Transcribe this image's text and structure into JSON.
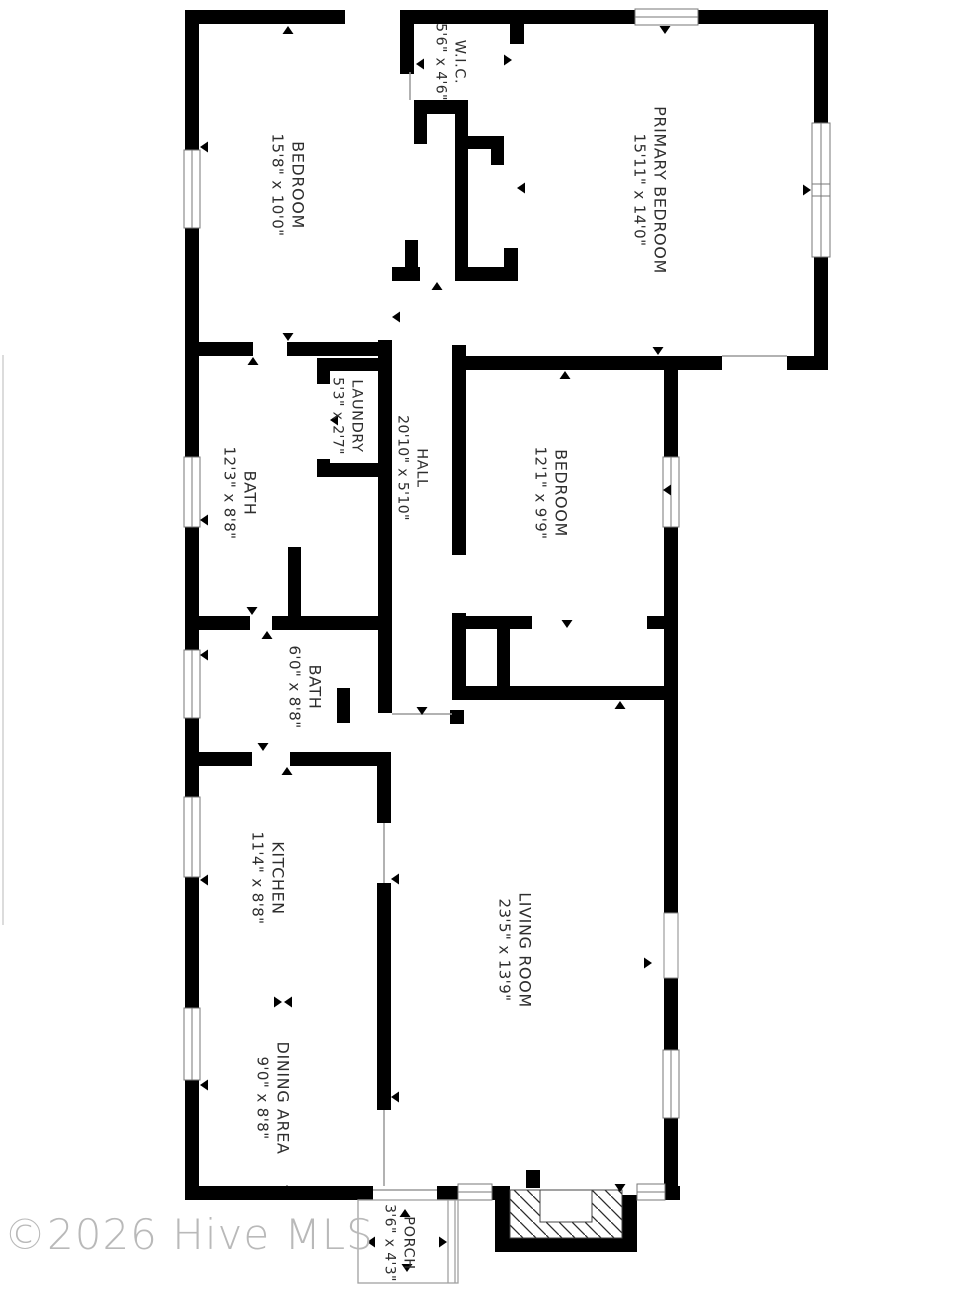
{
  "watermark": "©2026 Hive MLS",
  "rooms": [
    {
      "name": "BEDROOM",
      "dims": "15'8\" x 10'0\""
    },
    {
      "name": "W.I.C.",
      "dims": "5'6\" x 4'6\""
    },
    {
      "name": "PRIMARY BEDROOM",
      "dims": "15'11\" x 14'0\""
    },
    {
      "name": "BATH",
      "dims": "12'3\" x 8'8\""
    },
    {
      "name": "LAUNDRY",
      "dims": "5'3\" x 2'7\""
    },
    {
      "name": "HALL",
      "dims": "20'10\" x 5'10\""
    },
    {
      "name": "BEDROOM",
      "dims": "12'1\" x 9'9\""
    },
    {
      "name": "BATH",
      "dims": "6'0\" x 8'8\""
    },
    {
      "name": "KITCHEN",
      "dims": "11'4\" x 8'8\""
    },
    {
      "name": "LIVING ROOM",
      "dims": "23'5\" x 13'9\""
    },
    {
      "name": "DINING AREA",
      "dims": "9'0\" x 8'8\""
    },
    {
      "name": "PORCH",
      "dims": "3'6\" x 4'3\""
    }
  ],
  "colors": {
    "wall": "#000000",
    "thin_line": "#999999",
    "watermark": "#b9b9b9"
  }
}
